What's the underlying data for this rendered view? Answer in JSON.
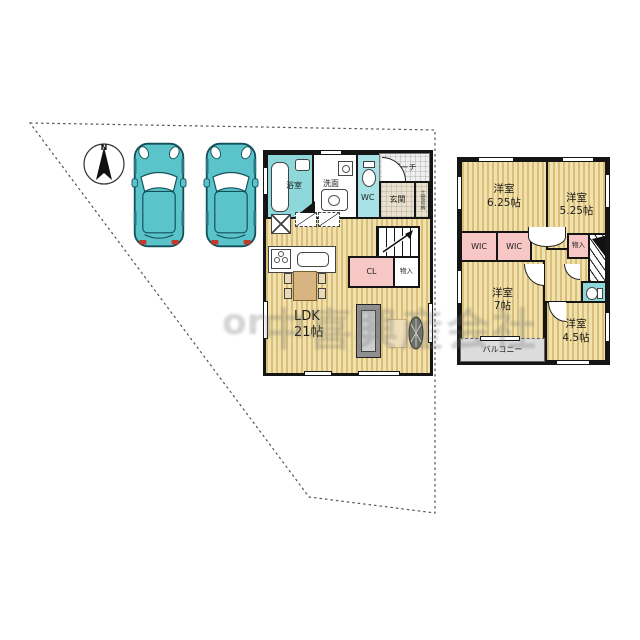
{
  "site": {
    "compass_label": "N",
    "cars": 2
  },
  "watermark": {
    "left": "or",
    "main": "中喜興産会社"
  },
  "floor1": {
    "rooms": {
      "bath": "浴室",
      "washroom": "洗面",
      "wc": "WC",
      "porch": "ポーチ",
      "entrance": "玄関",
      "doma": "土間収納",
      "closet": "CL",
      "storage": "物入",
      "ldk_line1": "LDK",
      "ldk_line2": "21帖"
    }
  },
  "floor2": {
    "rooms": {
      "room1_line1": "洋室",
      "room1_line2": "6.25帖",
      "room2_line1": "洋室",
      "room2_line2": "5.25帖",
      "wic1": "WIC",
      "wic2": "WIC",
      "storage": "物入",
      "room3_line1": "洋室",
      "room3_line2": "7帖",
      "room4_line1": "洋室",
      "room4_line2": "4.5帖",
      "balcony": "バルコニー"
    }
  },
  "colors": {
    "floor_stripe_base": "#f1e1ac",
    "floor_stripe": "#be963e",
    "wet_area_teal": "#8ed8dc",
    "closet_pink": "#f7c7c6",
    "balcony_gray": "#dcdcdc",
    "wall": "#151515",
    "car_body": "#5bc4cb"
  }
}
